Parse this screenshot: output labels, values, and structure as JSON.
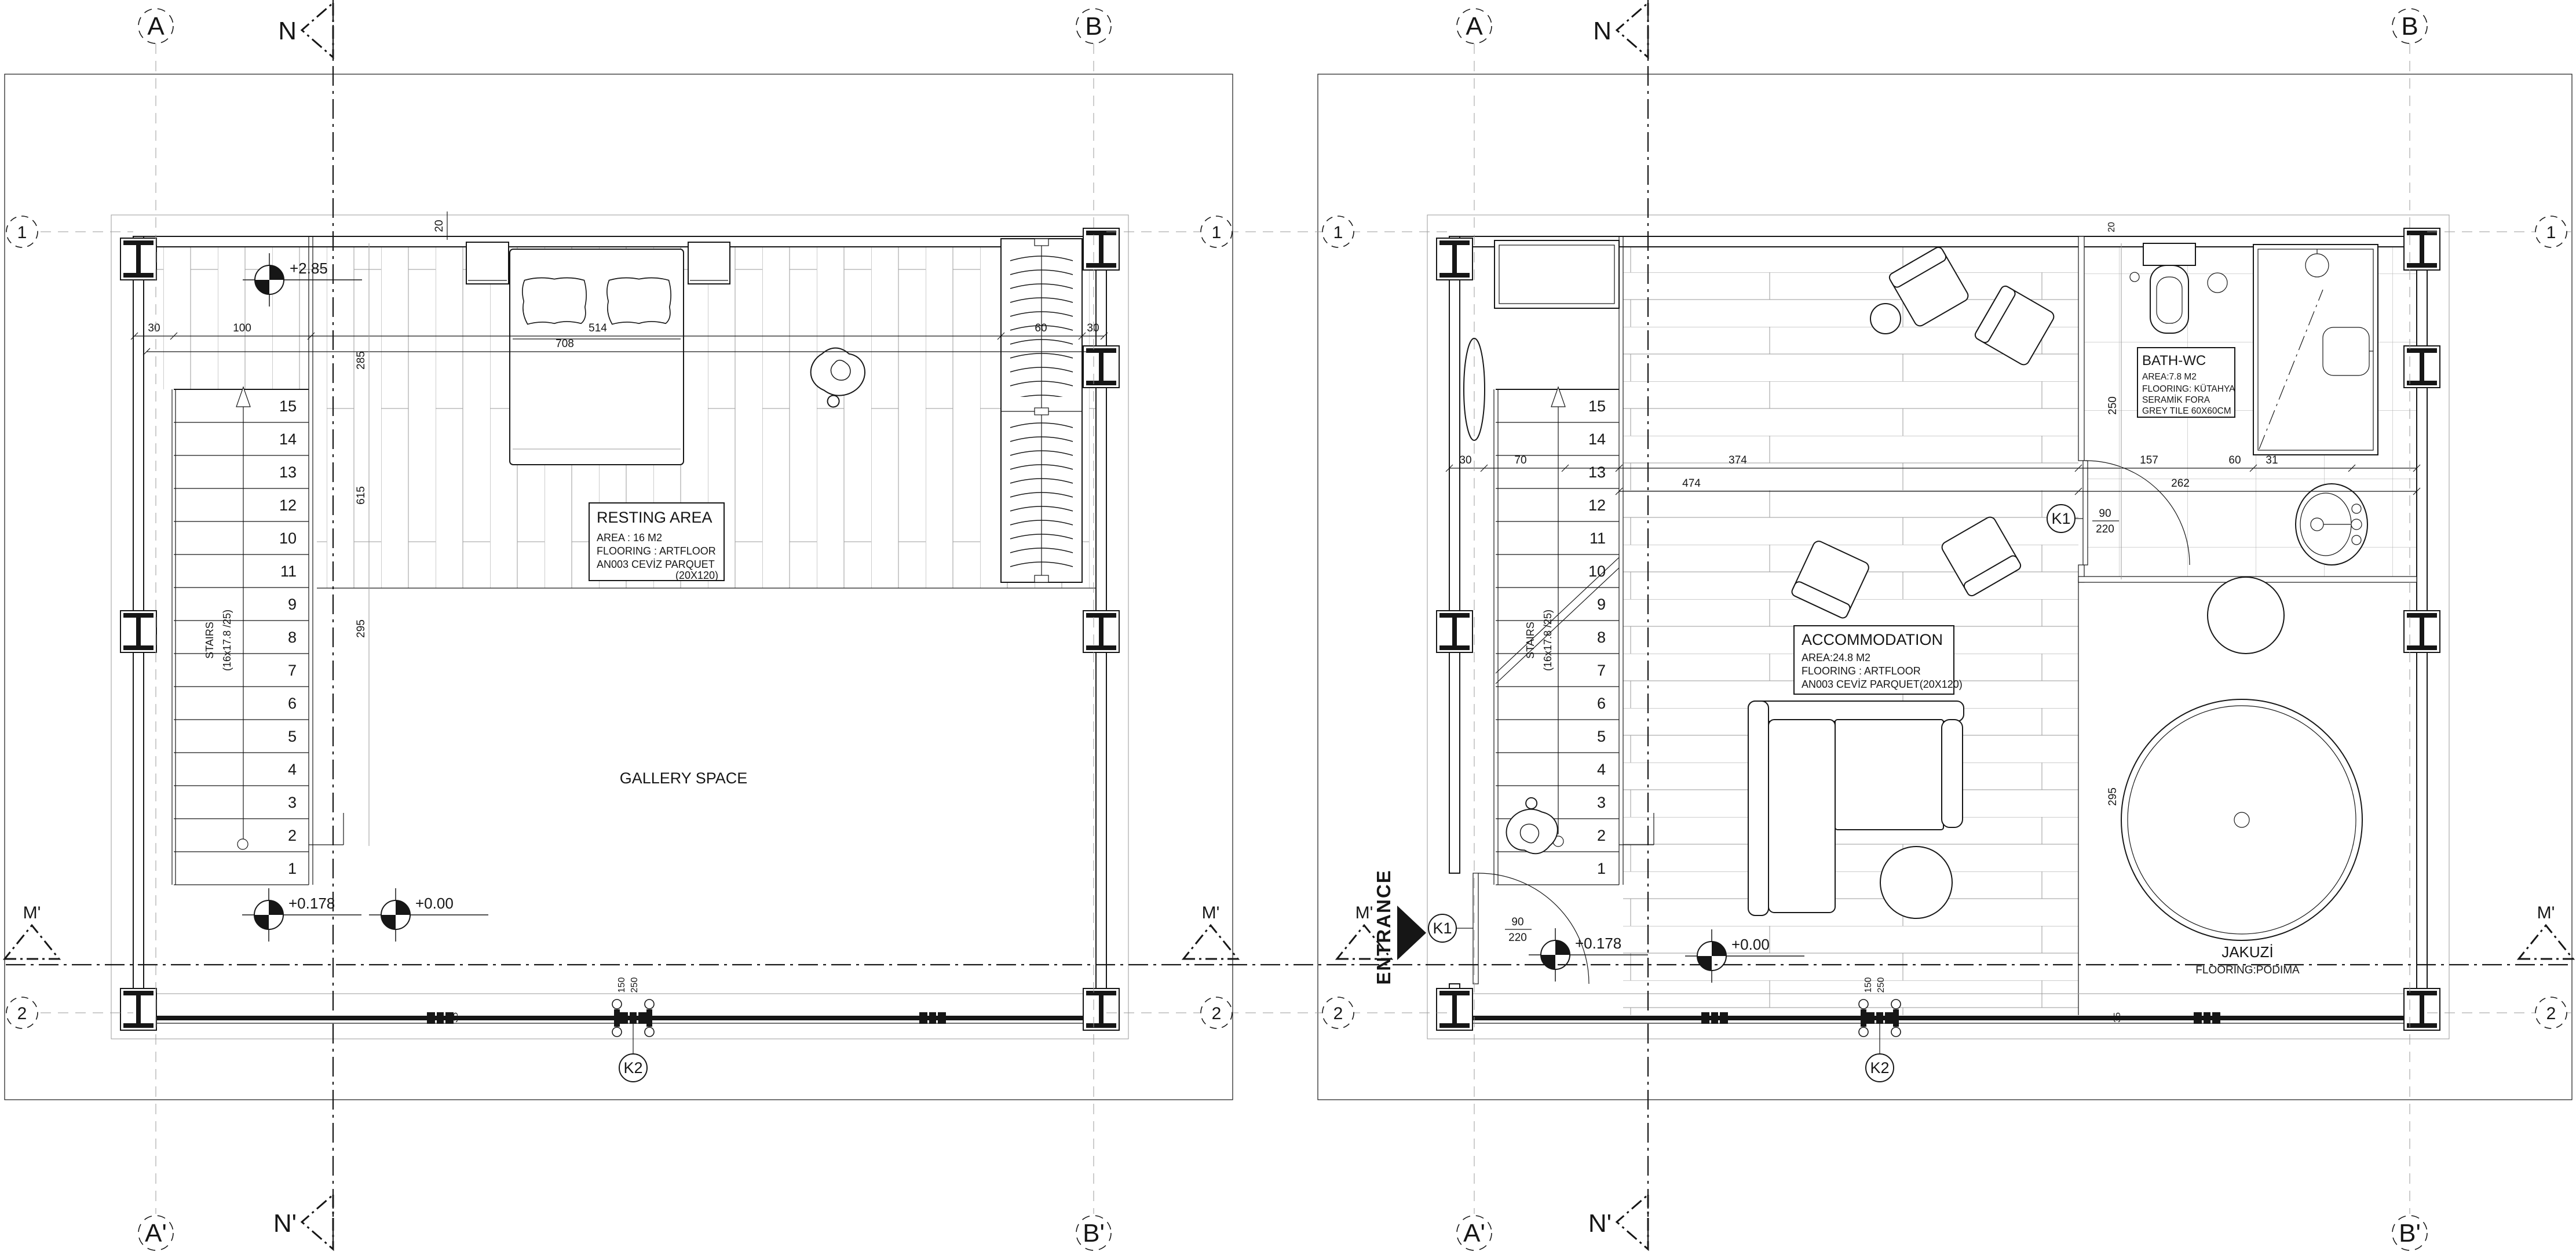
{
  "sheet": {
    "ink": "#161616",
    "bg": "#ffffff"
  },
  "grid": {
    "col_a": "A",
    "col_n": "N",
    "col_b": "B",
    "col_a_prime": "A'",
    "col_n_prime": "N'",
    "col_b_prime": "B'",
    "row_1": "1",
    "row_2": "2",
    "row_m": "M'",
    "key_k1": "K1",
    "key_k2": "K2"
  },
  "left_plan": {
    "resting_area": {
      "title": "RESTING AREA",
      "line1": "AREA : 16 M2",
      "line2": "FLOORING : ARTFLOOR",
      "line3": "AN003 CEVİZ PARQUET",
      "line4": "(20X120)"
    },
    "gallery": {
      "title": "GALLERY SPACE"
    },
    "stairs": {
      "label": "STAIRS",
      "spec": "(16x17.8 /25)",
      "numbers": [
        "15",
        "14",
        "13",
        "12",
        "10",
        "11",
        "9",
        "8",
        "7",
        "6",
        "5",
        "4",
        "3",
        "2",
        "1"
      ]
    },
    "levels": {
      "upper": "+2.85",
      "entry": "+0.178",
      "zero": "+0.00"
    },
    "dims": {
      "eave": "20",
      "wall": "30",
      "stair_w": "100",
      "bed_span": "514",
      "room_span": "708",
      "v1": "285",
      "v2": "615",
      "v3": "295",
      "wardrobe": "60",
      "wall_r": "30",
      "glass": "35",
      "k2_a": "150",
      "k2_b": "250"
    }
  },
  "right_plan": {
    "accommodation": {
      "title": "ACCOMMODATION",
      "line1": "AREA:24.8 M2",
      "line2": "FLOORING : ARTFLOOR",
      "line3": "AN003 CEVİZ PARQUET(20X120)"
    },
    "bath": {
      "title": "BATH-WC",
      "line1": "AREA:7.8 M2",
      "line2": "FLOORING: KÜTAHYA",
      "line3": "SERAMİK FORA",
      "line4": "GREY TILE 60X60CM"
    },
    "jacuzzi": {
      "title": "JAKUZİ",
      "subtitle": "FLOORING:PODIMA"
    },
    "entrance": {
      "label": "ENTRANCE"
    },
    "stairs": {
      "label": "STAIRS",
      "spec": "(16x17.8 /25)",
      "numbers": [
        "15",
        "14",
        "13",
        "12",
        "11",
        "10",
        "9",
        "8",
        "7",
        "6",
        "5",
        "4",
        "3",
        "2",
        "1"
      ]
    },
    "levels": {
      "entry": "+0.178",
      "zero": "+0.00"
    },
    "doors": {
      "k1_w": "90",
      "k1_h": "220"
    },
    "dims": {
      "eave": "20",
      "wall": "30",
      "d70": "70",
      "d374": "374",
      "d474": "474",
      "d157": "157",
      "d60": "60",
      "d31": "31",
      "d262": "262",
      "v1": "250",
      "v2": "295",
      "glass": "35",
      "k2_a": "150",
      "k2_b": "250"
    }
  }
}
